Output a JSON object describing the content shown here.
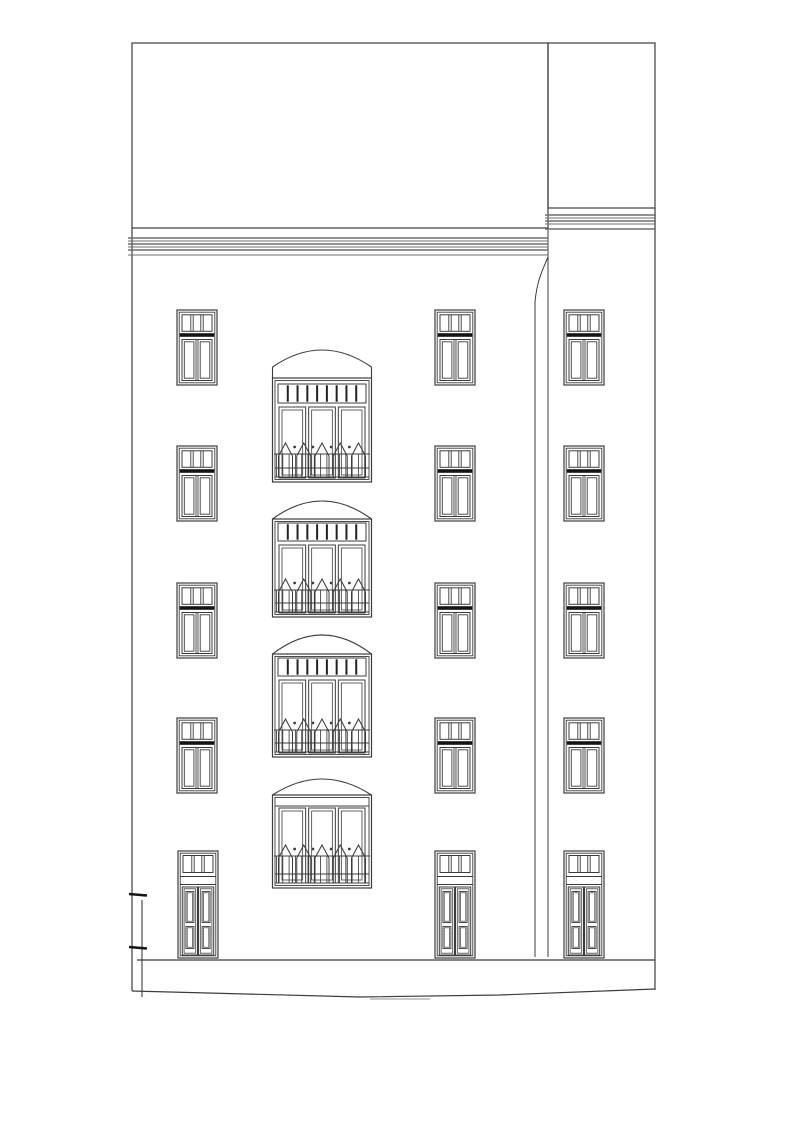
{
  "drawing": {
    "type": "architectural-elevation-line-drawing",
    "canvas": {
      "width": 800,
      "height": 1134
    },
    "colors": {
      "background": "#ffffff",
      "line": "#3c3c3c",
      "light": "#6f6f6f",
      "heavy": "#141414"
    },
    "main_block": {
      "left": 132,
      "top": 43,
      "right": 548,
      "attic_bottom": 228,
      "wall_left_bottom": 991,
      "cornice": {
        "left": 128,
        "right": 548,
        "lines": [
          238,
          241,
          244,
          247,
          250,
          255
        ]
      }
    },
    "side_block": {
      "left": 548,
      "top": 43,
      "right": 655,
      "attic_bottom": 208,
      "divider_bottom": 957,
      "right_edge_bottom": 990,
      "cornice": {
        "left": 545,
        "right": 656,
        "lines": [
          215,
          218,
          221,
          224,
          229
        ]
      }
    },
    "corner_curve": {
      "from_x": 548,
      "from_y": 257,
      "to_x": 535,
      "to_y": 302,
      "line_bottom": 957
    },
    "base": {
      "band_y": 960,
      "band_left": 137,
      "band_right": 655,
      "ground_points": [
        [
          132,
          991
        ],
        [
          360,
          997
        ],
        [
          500,
          995
        ],
        [
          655,
          989
        ]
      ],
      "stray_mark": [
        370,
        999,
        430,
        999
      ]
    },
    "left_post": {
      "x": 142,
      "top": 900,
      "bottom": 997,
      "caps": [
        894,
        947
      ],
      "cap_left": 129,
      "cap_right": 147
    },
    "small_windows": {
      "width": 40,
      "height": 75,
      "columns": [
        177,
        435,
        564
      ],
      "rows": [
        310,
        446,
        583,
        718
      ],
      "transom_panes": 3,
      "casements": 2
    },
    "doors": {
      "width": 40,
      "height": 107,
      "top": 851,
      "columns": [
        178,
        435,
        564
      ],
      "transom_panes": 3,
      "leaves": 2,
      "panels_per_leaf": 2
    },
    "bays": {
      "x": 272.5,
      "width": 99,
      "transom_cells": 9,
      "panel_count": 3,
      "rail_peaks": 5,
      "floors": [
        {
          "peak": 350,
          "arch_base": 367,
          "top": 378,
          "band_top": 384,
          "band_bottom": 403,
          "has_transom": true,
          "panels_top": 407,
          "panels_bottom": 478,
          "rail_top": 443,
          "bottom": 482
        },
        {
          "peak": 501,
          "arch_base": 519,
          "top": 519,
          "band_top": 523,
          "band_bottom": 541,
          "has_transom": true,
          "panels_top": 545,
          "panels_bottom": 613,
          "rail_top": 579,
          "bottom": 617
        },
        {
          "peak": 635,
          "arch_base": 654,
          "top": 654,
          "band_top": 658,
          "band_bottom": 676,
          "has_transom": true,
          "panels_top": 680,
          "panels_bottom": 753,
          "rail_top": 719,
          "bottom": 757
        },
        {
          "peak": 779,
          "arch_base": 795,
          "top": 795,
          "band_top": 795,
          "band_bottom": 806,
          "has_transom": false,
          "panels_top": 808,
          "panels_bottom": 883,
          "rail_top": 845,
          "bottom": 888
        }
      ]
    }
  }
}
